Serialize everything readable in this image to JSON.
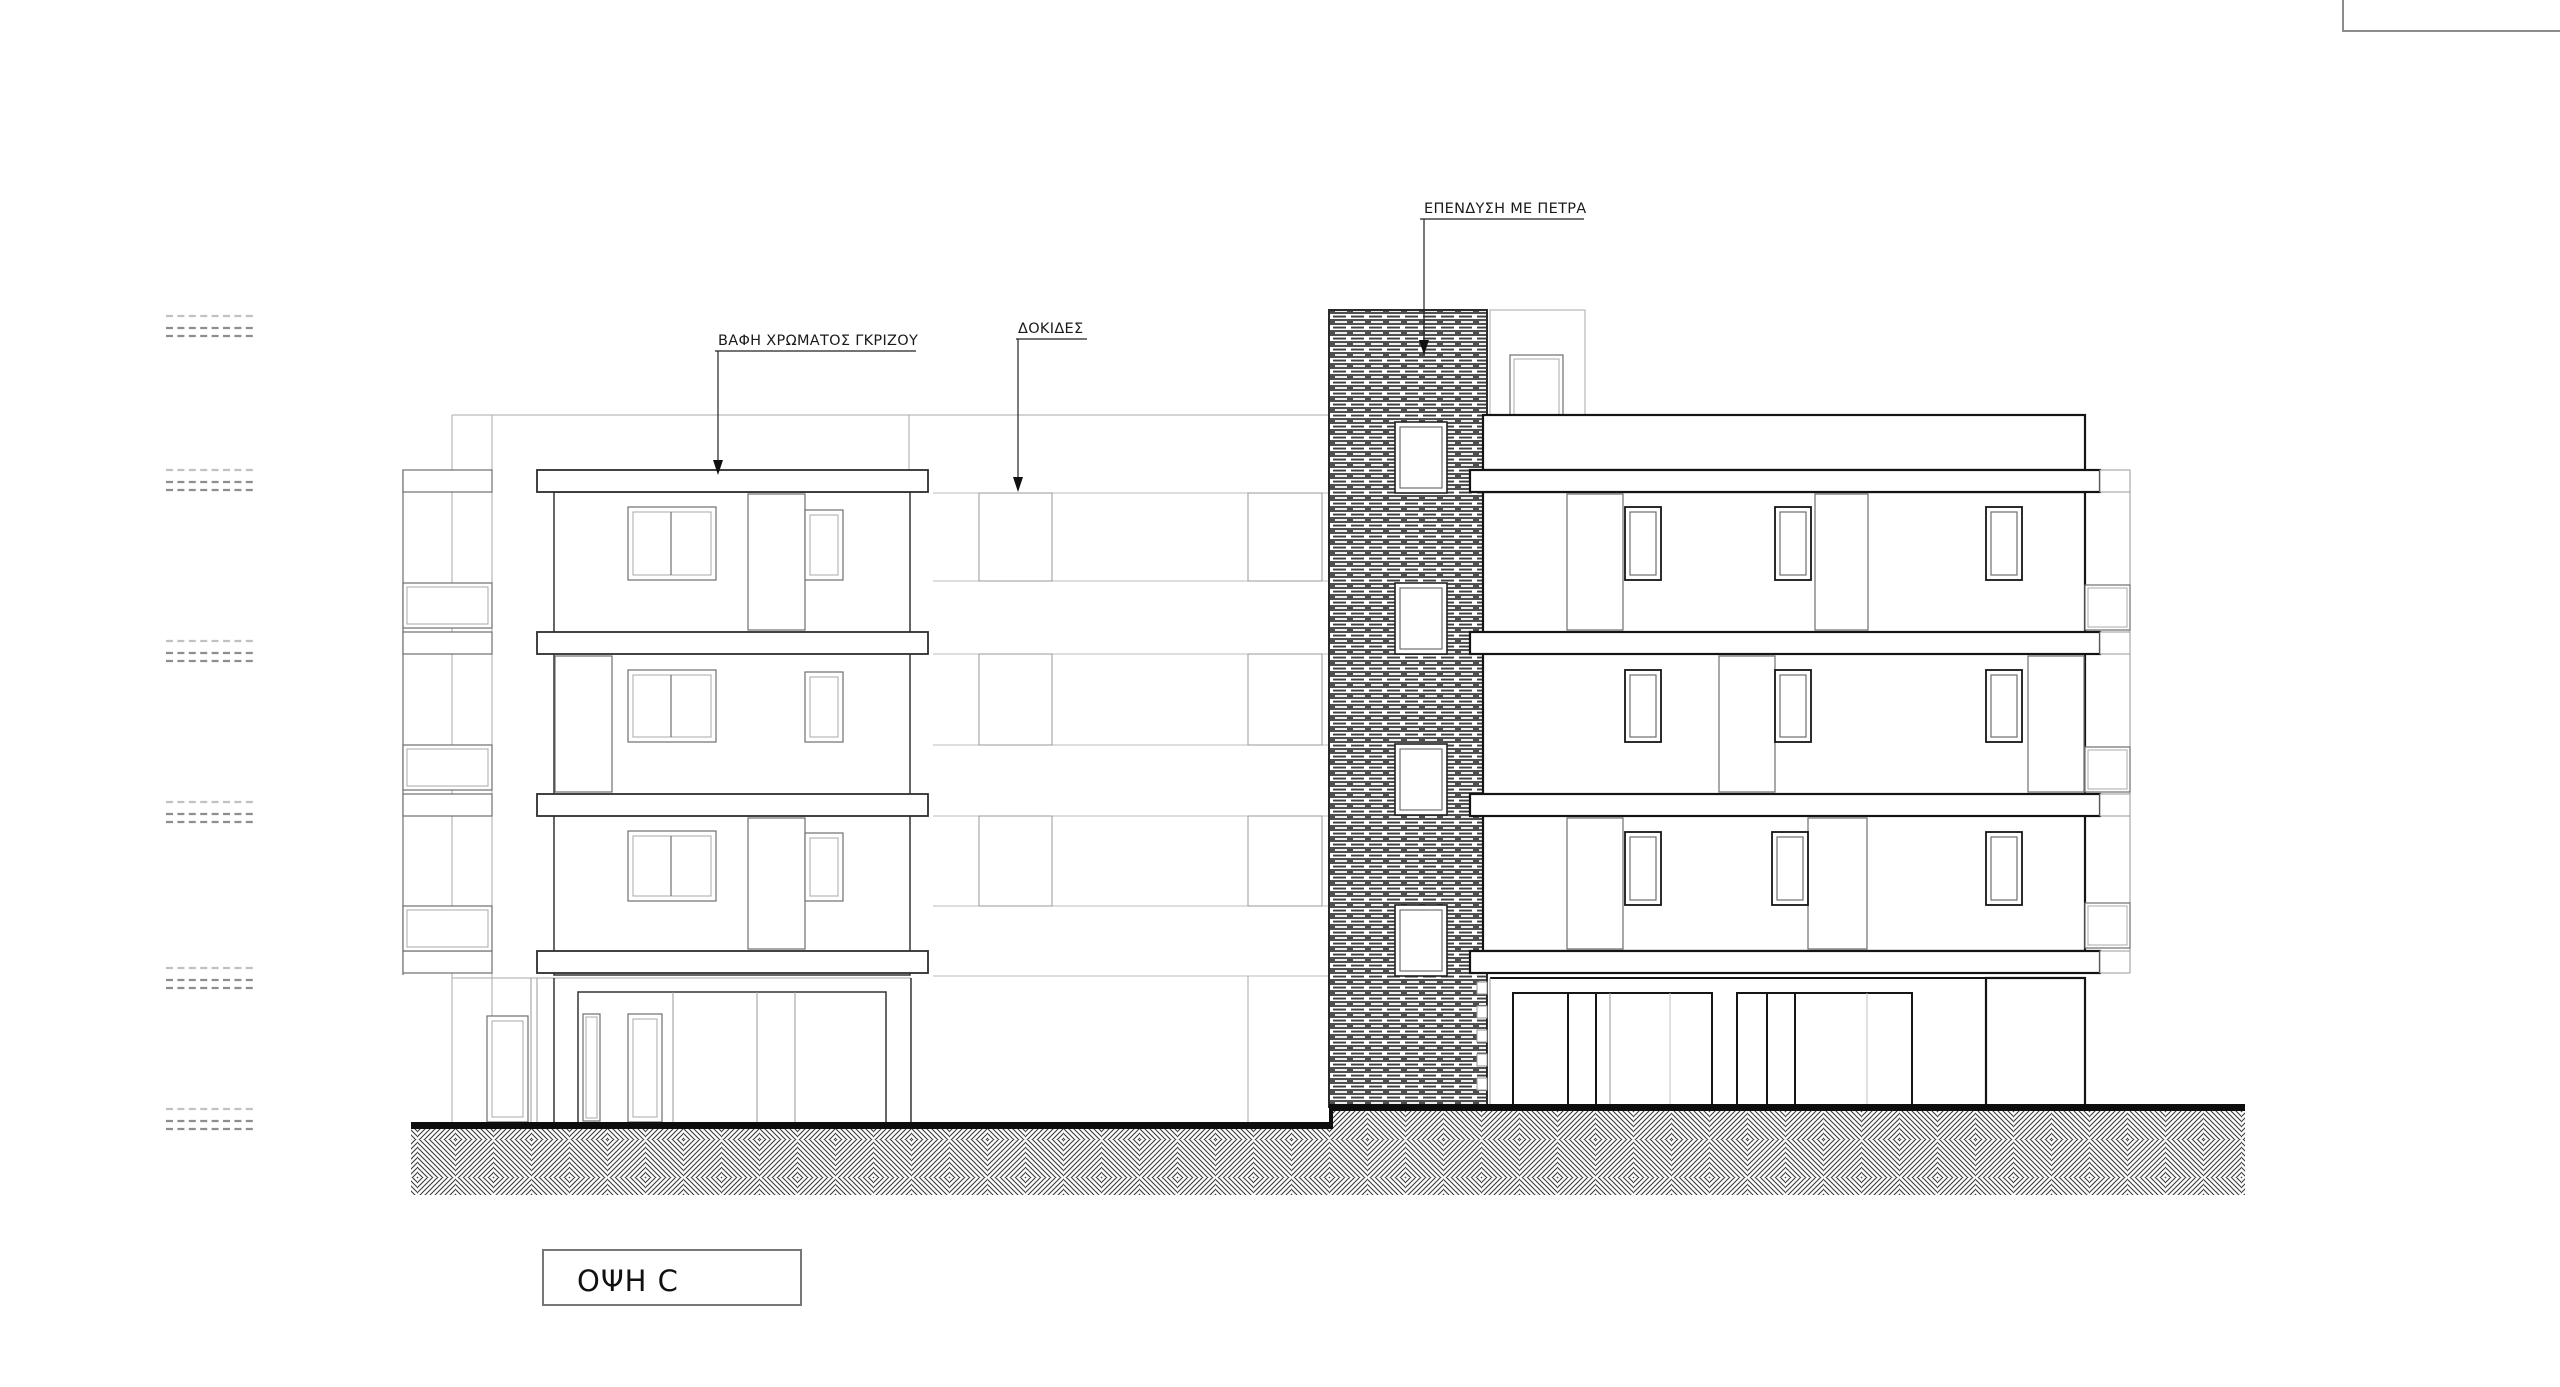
{
  "annotations": {
    "stone_cladding": "ΕΠΕΝΔΥΣΗ ΜΕ ΠΕΤΡΑ",
    "grey_paint": "ΒΑΦΗ ΧΡΩΜΑΤΟΣ ΓΚΡΙΖΟΥ",
    "joists": "ΔΟΚΙΔΕΣ"
  },
  "title_block": {
    "label": "ΟΨΗ C"
  },
  "colors": {
    "paper": "#ffffff",
    "ink": "#1a1a1a",
    "line-bg": "#a8a8a8",
    "line-med": "#6f6f6f",
    "line-left": "#333333",
    "line-right": "#141414",
    "ground": "#0d0d0d",
    "stone-band": "#4f4f4f",
    "hatch-line": "#3a3a3a",
    "frame": "#7d7d7d"
  }
}
